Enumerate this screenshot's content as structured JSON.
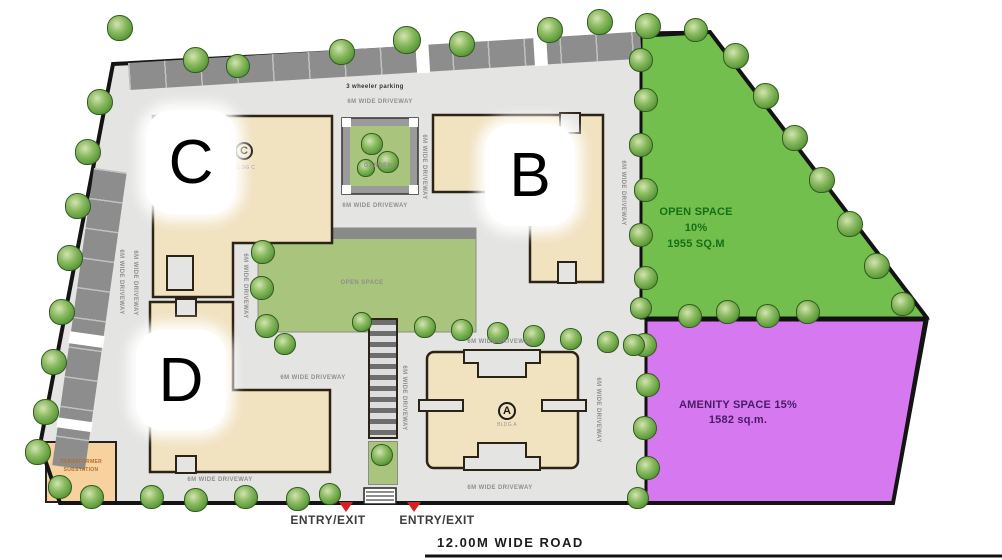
{
  "site": {
    "road_label": "12.00M WIDE ROAD",
    "entry_exit_label": "ENTRY/EXIT",
    "parking_label": "3 wheeler parking",
    "open_space": {
      "title": "OPEN SPACE",
      "percent": "10%",
      "area": "1955 SQ.M"
    },
    "amenity": {
      "title": "AMENITY SPACE 15%",
      "area": "1582 sq.m."
    },
    "transformer": {
      "line1": "TRANSFORMER",
      "line2": "SUBSTATION"
    },
    "buildings": {
      "a": {
        "letter": "A",
        "sub": "BLDG A"
      },
      "b": {
        "letter": "B"
      },
      "c": {
        "letter": "C",
        "sub": "BLDG C"
      },
      "d": {
        "letter": "D"
      }
    },
    "tiny_labels": [
      {
        "t": "6M WIDE DRIVEWAY",
        "x": 380,
        "y": 102
      },
      {
        "t": "6M WIDE DRIVEWAY",
        "x": 375,
        "y": 206
      },
      {
        "t": "6M WIDE DRIVEWAY",
        "x": 500,
        "y": 342
      },
      {
        "t": "6M WIDE DRIVEWAY",
        "x": 500,
        "y": 488
      },
      {
        "t": "6M WIDE DRIVEWAY",
        "x": 220,
        "y": 480
      },
      {
        "t": "6M WIDE DRIVEWAY",
        "x": 313,
        "y": 378
      },
      {
        "t": "OPEN SPACE",
        "x": 362,
        "y": 283
      },
      {
        "t": "GARDEN",
        "x": 378,
        "y": 166
      },
      {
        "t": "6M WIDE DRIVEWAY",
        "x": 121,
        "y": 282,
        "v": 1
      },
      {
        "t": "6M WIDE DRIVEWAY",
        "x": 135,
        "y": 283,
        "v": 1
      },
      {
        "t": "6M WIDE DRIVEWAY",
        "x": 245,
        "y": 286,
        "v": 1
      },
      {
        "t": "6M WIDE DRIVEWAY",
        "x": 424,
        "y": 167,
        "v": 1
      },
      {
        "t": "6M WIDE DRIVEWAY",
        "x": 404,
        "y": 398,
        "v": 1
      },
      {
        "t": "6M WIDE DRIVEWAY",
        "x": 598,
        "y": 410,
        "v": 1
      },
      {
        "t": "6M WIDE DRIVEWAY",
        "x": 623,
        "y": 193,
        "v": 1
      }
    ]
  },
  "colors": {
    "open_space": "#72bf4e",
    "amenity": "#d678f0",
    "building": "#f1e2c0",
    "lawn": "#a9c47d",
    "site_bg": "#e4e4e2",
    "parking": "#8d8d8d",
    "entry_marker": "#d42020"
  },
  "trees": [
    [
      120,
      28,
      26
    ],
    [
      196,
      60,
      26
    ],
    [
      238,
      66,
      24
    ],
    [
      342,
      52,
      26
    ],
    [
      407,
      40,
      28
    ],
    [
      462,
      44,
      26
    ],
    [
      550,
      30,
      26
    ],
    [
      600,
      22,
      26
    ],
    [
      648,
      26,
      26
    ],
    [
      696,
      30,
      24
    ],
    [
      736,
      56,
      26
    ],
    [
      766,
      96,
      26
    ],
    [
      795,
      138,
      26
    ],
    [
      822,
      180,
      26
    ],
    [
      850,
      224,
      26
    ],
    [
      877,
      266,
      26
    ],
    [
      903,
      304,
      24
    ],
    [
      641,
      60,
      24
    ],
    [
      646,
      100,
      24
    ],
    [
      641,
      145,
      24
    ],
    [
      646,
      190,
      24
    ],
    [
      641,
      235,
      24
    ],
    [
      646,
      278,
      24
    ],
    [
      641,
      308,
      22
    ],
    [
      690,
      316,
      24
    ],
    [
      728,
      312,
      24
    ],
    [
      768,
      316,
      24
    ],
    [
      808,
      312,
      24
    ],
    [
      645,
      345,
      24
    ],
    [
      648,
      385,
      24
    ],
    [
      645,
      428,
      24
    ],
    [
      648,
      468,
      24
    ],
    [
      638,
      498,
      22
    ],
    [
      100,
      102,
      26
    ],
    [
      88,
      152,
      26
    ],
    [
      78,
      206,
      26
    ],
    [
      70,
      258,
      26
    ],
    [
      62,
      312,
      26
    ],
    [
      54,
      362,
      26
    ],
    [
      46,
      412,
      26
    ],
    [
      38,
      452,
      26
    ],
    [
      60,
      487,
      24
    ],
    [
      92,
      497,
      24
    ],
    [
      152,
      497,
      24
    ],
    [
      196,
      500,
      24
    ],
    [
      246,
      497,
      24
    ],
    [
      298,
      499,
      24
    ],
    [
      330,
      494,
      22
    ],
    [
      263,
      252,
      24
    ],
    [
      262,
      288,
      24
    ],
    [
      267,
      326,
      24
    ],
    [
      285,
      344,
      22
    ],
    [
      425,
      327,
      22
    ],
    [
      462,
      330,
      22
    ],
    [
      498,
      333,
      22
    ],
    [
      534,
      336,
      22
    ],
    [
      571,
      339,
      22
    ],
    [
      608,
      342,
      22
    ],
    [
      634,
      345,
      22
    ],
    [
      372,
      144,
      22
    ],
    [
      388,
      162,
      22
    ],
    [
      366,
      168,
      18
    ],
    [
      362,
      322,
      20
    ],
    [
      382,
      455,
      22
    ]
  ]
}
